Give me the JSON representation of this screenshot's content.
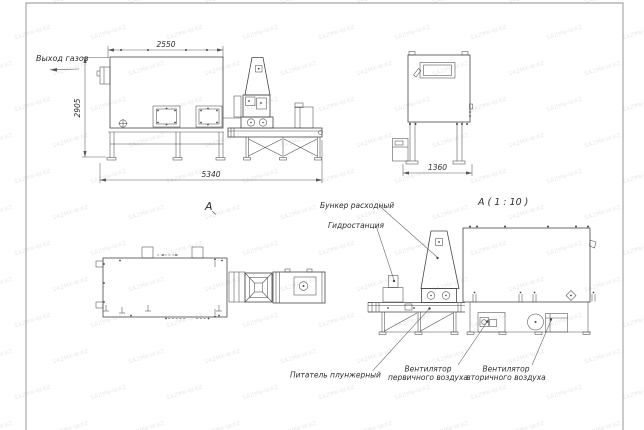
{
  "sheet": {
    "watermark_text": "SAZMK-W.KZ",
    "colors": {
      "background": "#ffffff",
      "line": "#474747",
      "dimension": "#5a5a5a",
      "text": "#2e2e2e",
      "frame": "#8f8f8f"
    }
  },
  "views": {
    "side": {
      "dim_width": "2550",
      "dim_height": "2905",
      "dim_length": "5340",
      "gas_outlet_label": "Выход газов"
    },
    "front": {
      "dim_width": "1360"
    },
    "plan": {
      "label": "А"
    },
    "detail": {
      "label": "А ( 1 : 10 )",
      "callouts": {
        "feed_hopper": "Бункер расходный",
        "hydraulic_station": "Гидростанция",
        "plunger_feeder": "Питатель плунжерный",
        "primary_fan_l1": "Вентилятор",
        "primary_fan_l2": "первичного воздуха",
        "secondary_fan_l1": "Вентилятор",
        "secondary_fan_l2": "вторичного воздуха"
      }
    }
  }
}
